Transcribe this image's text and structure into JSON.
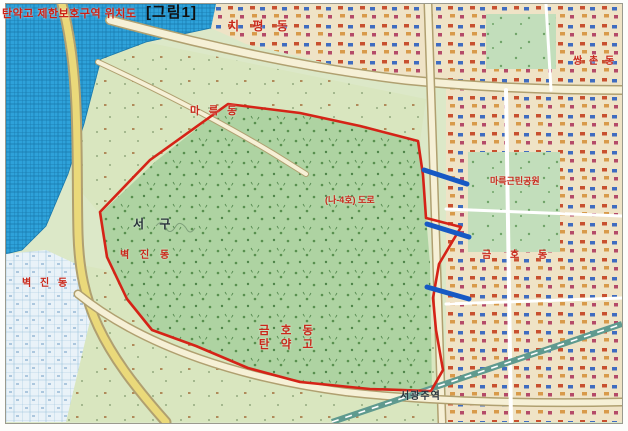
{
  "title": "탄약고 제한보호구역 위치도",
  "figure_label": "[그림1]",
  "labels": {
    "chipyeong": "치 평 동",
    "ssangchon": "쌍 촌 동",
    "mareuk": "마 륵 동",
    "byeokjin_west": "벽 진 동",
    "seo_gu": "서  구",
    "byeokjin": "벽 진 동",
    "road": "(나-4호) 도로",
    "park": "마륵근린공원",
    "geumho": "금 호 동",
    "depot_line1": "금 호 동",
    "depot_line2": "탄 약 고",
    "station": "서광주역"
  },
  "colors": {
    "boundary": "#d52317",
    "blue_marks": "#1659c4",
    "label_red": "#c9281a",
    "water": "#2ea2da",
    "forest": "#aed3a2"
  }
}
